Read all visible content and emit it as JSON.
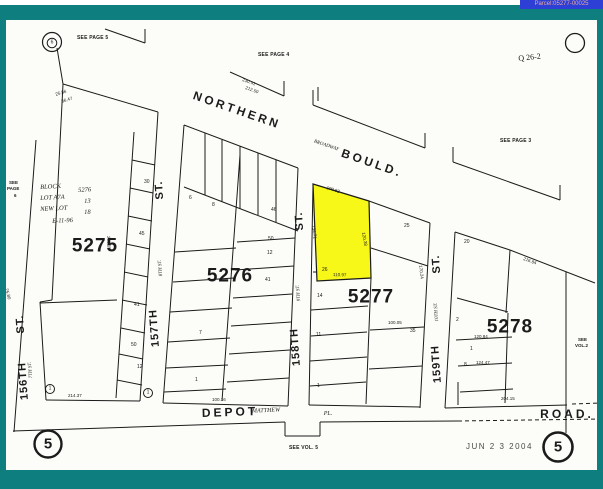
{
  "header": {
    "parcel_tag": "Parcel:05277-00025"
  },
  "colors": {
    "frame": "#0e7f7e",
    "paper": "#fcfcf8",
    "ink": "#1b1b1b",
    "highlight": "#f8f818",
    "tag_bg": "#2d3fd4",
    "tag_text": "#e9a9a1"
  },
  "map": {
    "highlight_parcel": {
      "points": "313,184 369,201 371,278 317,281"
    },
    "circles": [
      {
        "cx": 52,
        "cy": 42,
        "r": 9.5,
        "w": 1.2,
        "n": "symbol-6-outer-circle"
      },
      {
        "cx": 52,
        "cy": 43,
        "r": 4.8,
        "w": 1,
        "n": "symbol-6-inner-circle"
      },
      {
        "cx": 575,
        "cy": 43,
        "r": 9.5,
        "w": 1.3,
        "n": "corner-circle"
      },
      {
        "cx": 48,
        "cy": 444,
        "r": 13.5,
        "w": 2.4,
        "n": "page-circle-left"
      },
      {
        "cx": 558,
        "cy": 447,
        "r": 14.5,
        "w": 2.6,
        "n": "page-circle-right"
      },
      {
        "cx": 50,
        "cy": 389,
        "r": 4.5,
        "w": 1,
        "n": "lot-circle"
      },
      {
        "cx": 148,
        "cy": 393,
        "r": 4.5,
        "w": 1,
        "n": "lot-circle"
      }
    ],
    "lines": [
      [
        105,
        29,
        145,
        43
      ],
      [
        145,
        29,
        145,
        43
      ],
      [
        230,
        72,
        284,
        96
      ],
      [
        284,
        81,
        284,
        96
      ],
      [
        318,
        87,
        318,
        101
      ],
      [
        313,
        90,
        313,
        105
      ],
      [
        313,
        105,
        425,
        148
      ],
      [
        425,
        133,
        425,
        148
      ],
      [
        453,
        147,
        453,
        162
      ],
      [
        453,
        162,
        560,
        200
      ],
      [
        560,
        185,
        560,
        200
      ],
      [
        57,
        48,
        63,
        84
      ],
      [
        63,
        84,
        158,
        112
      ],
      [
        184,
        125,
        298,
        168
      ],
      [
        369,
        201,
        430,
        223
      ],
      [
        455,
        232,
        510,
        250
      ],
      [
        510,
        250,
        595,
        283
      ],
      [
        36,
        140,
        14,
        432
      ],
      [
        63,
        84,
        52,
        300
      ],
      [
        52,
        300,
        40,
        302
      ],
      [
        40,
        302,
        46,
        400
      ],
      [
        40,
        303,
        117,
        300
      ],
      [
        158,
        112,
        140,
        401
      ],
      [
        134,
        132,
        116,
        398
      ],
      [
        132,
        160,
        155,
        165
      ],
      [
        130,
        188,
        153,
        193
      ],
      [
        128,
        216,
        152,
        221
      ],
      [
        126,
        244,
        150,
        249
      ],
      [
        124,
        272,
        148,
        277
      ],
      [
        122,
        300,
        147,
        305
      ],
      [
        121,
        328,
        145,
        333
      ],
      [
        119,
        354,
        143,
        359
      ],
      [
        117,
        380,
        142,
        385
      ],
      [
        184,
        125,
        163,
        403
      ],
      [
        298,
        168,
        288,
        406
      ],
      [
        240,
        155,
        222,
        401
      ],
      [
        184,
        187,
        298,
        231
      ],
      [
        205,
        133,
        205,
        195
      ],
      [
        222,
        139,
        222,
        202
      ],
      [
        240,
        146,
        240,
        209
      ],
      [
        258,
        153,
        258,
        215
      ],
      [
        276,
        160,
        276,
        222
      ],
      [
        175,
        252,
        236,
        248
      ],
      [
        173,
        282,
        234,
        278
      ],
      [
        170,
        312,
        232,
        308
      ],
      [
        168,
        342,
        230,
        338
      ],
      [
        166,
        368,
        228,
        365
      ],
      [
        164,
        392,
        226,
        389
      ],
      [
        237,
        242,
        295,
        238
      ],
      [
        235,
        270,
        294,
        266
      ],
      [
        233,
        298,
        292,
        294
      ],
      [
        231,
        326,
        291,
        322
      ],
      [
        229,
        354,
        290,
        350
      ],
      [
        227,
        382,
        289,
        378
      ],
      [
        313,
        184,
        309,
        405
      ],
      [
        430,
        223,
        420,
        408
      ],
      [
        371,
        278,
        366,
        404
      ],
      [
        371,
        248,
        428,
        266
      ],
      [
        311,
        310,
        368,
        306
      ],
      [
        311,
        336,
        367,
        332
      ],
      [
        310,
        361,
        367,
        357
      ],
      [
        310,
        386,
        366,
        382
      ],
      [
        370,
        330,
        424,
        327
      ],
      [
        369,
        369,
        422,
        366
      ],
      [
        313,
        272,
        325,
        272
      ],
      [
        325,
        272,
        325,
        281
      ],
      [
        455,
        232,
        445,
        408
      ],
      [
        510,
        250,
        506,
        313
      ],
      [
        508,
        313,
        505,
        403
      ],
      [
        457,
        298,
        508,
        312
      ],
      [
        456,
        340,
        512,
        337
      ],
      [
        458,
        366,
        512,
        363
      ],
      [
        460,
        392,
        513,
        389
      ],
      [
        566,
        272,
        566,
        433
      ],
      [
        46,
        400,
        140,
        401
      ],
      [
        163,
        403,
        288,
        406
      ],
      [
        309,
        405,
        420,
        407
      ],
      [
        445,
        408,
        567,
        405
      ],
      [
        458,
        382,
        458,
        405
      ],
      [
        13,
        431,
        285,
        422
      ],
      [
        285,
        422,
        285,
        436
      ],
      [
        285,
        436,
        320,
        436
      ],
      [
        320,
        436,
        320,
        422
      ],
      [
        320,
        422,
        458,
        421
      ]
    ],
    "dashed": [
      [
        458,
        421,
        600,
        419
      ],
      [
        572,
        404,
        600,
        403
      ]
    ],
    "labels": [
      {
        "t": "SEE PAGE 5",
        "x": 77,
        "y": 36,
        "cls": "ref",
        "n": "see-page-5"
      },
      {
        "t": "SEE PAGE 4",
        "x": 258,
        "y": 53,
        "cls": "ref",
        "n": "see-page-4"
      },
      {
        "t": "SEE PAGE 3",
        "x": 500,
        "y": 139,
        "cls": "ref",
        "n": "see-page-3"
      },
      {
        "t": "SEE",
        "x": 9,
        "y": 181,
        "cls": "ref2",
        "n": "see-page-6"
      },
      {
        "t": "PAGE",
        "x": 7,
        "y": 187,
        "cls": "ref2",
        "n": "see-page-6"
      },
      {
        "t": "6",
        "x": 14,
        "y": 194,
        "cls": "ref2",
        "n": "see-page-6"
      },
      {
        "t": "SEE VOL. 5",
        "x": 289,
        "y": 446,
        "cls": "ref",
        "n": "see-vol-5"
      },
      {
        "t": "SEE",
        "x": 578,
        "y": 338,
        "cls": "ref2",
        "n": "see-vol-2"
      },
      {
        "t": "VOL.2",
        "x": 575,
        "y": 344,
        "cls": "ref2",
        "n": "see-vol-2"
      },
      {
        "t": "Q 26-2",
        "x": 518,
        "y": 55,
        "rot": -6,
        "cls": "qnote",
        "n": "handwritten-note"
      },
      {
        "t": "NORTHERN",
        "x": 237,
        "y": 110,
        "rot": 19,
        "ctr": 1,
        "cls": "roadname",
        "n": "street-name-northern"
      },
      {
        "t": "BOULD.",
        "x": 372,
        "y": 163,
        "rot": 19,
        "ctr": 1,
        "cls": "roadname",
        "n": "street-name-bould"
      },
      {
        "t": "BROADWAY",
        "x": 326,
        "y": 146,
        "rot": 19,
        "ctr": 1,
        "cls": "st-old",
        "n": "old-street-name-broadway"
      },
      {
        "t": "DEPOT",
        "x": 230,
        "y": 412,
        "rot": -2,
        "ctr": 1,
        "cls": "roadname",
        "n": "street-name-depot"
      },
      {
        "t": "MATTHEW",
        "x": 266,
        "y": 411,
        "rot": -2,
        "ctr": 1,
        "cls": "road-it",
        "n": "old-street-name-matthew"
      },
      {
        "t": "PL.",
        "x": 328,
        "y": 414,
        "ctr": 1,
        "cls": "road-it",
        "n": "old-street-name-pl"
      },
      {
        "t": "ROAD.",
        "x": 567,
        "y": 414,
        "ctr": 1,
        "cls": "roadname",
        "n": "street-name-road"
      },
      {
        "t": "ST.",
        "x": 21,
        "y": 324,
        "rot": -94,
        "ctr": 1,
        "cls": "st-big",
        "n": "street-156-st"
      },
      {
        "t": "156TH",
        "x": 24,
        "y": 381,
        "rot": -94,
        "ctr": 1,
        "cls": "st-big",
        "n": "street-156"
      },
      {
        "t": "7TH ST.",
        "x": 31,
        "y": 370,
        "rot": -94,
        "ctr": 1,
        "cls": "st-old",
        "n": "old-street-156"
      },
      {
        "t": "ST.",
        "x": 160,
        "y": 190,
        "rot": -94,
        "ctr": 1,
        "cls": "st-big",
        "n": "street-157-st"
      },
      {
        "t": "157TH",
        "x": 155,
        "y": 328,
        "rot": -94,
        "ctr": 1,
        "cls": "st-big",
        "n": "street-157"
      },
      {
        "t": "8TH ST.",
        "x": 161,
        "y": 268,
        "rot": -94,
        "ctr": 1,
        "cls": "st-old",
        "n": "old-street-157"
      },
      {
        "t": "ST.",
        "x": 300,
        "y": 221,
        "rot": -94,
        "ctr": 1,
        "cls": "st-big",
        "n": "street-158-st"
      },
      {
        "t": "158TH",
        "x": 296,
        "y": 347,
        "rot": -94,
        "ctr": 1,
        "cls": "st-big",
        "n": "street-158"
      },
      {
        "t": "9TH ST.",
        "x": 299,
        "y": 293,
        "rot": -94,
        "ctr": 1,
        "cls": "st-old",
        "n": "old-street-158"
      },
      {
        "t": "ST.",
        "x": 437,
        "y": 264,
        "rot": -94,
        "ctr": 1,
        "cls": "st-big",
        "n": "street-159-st"
      },
      {
        "t": "159TH",
        "x": 437,
        "y": 364,
        "rot": -94,
        "ctr": 1,
        "cls": "st-big",
        "n": "street-159"
      },
      {
        "t": "10TH ST.",
        "x": 437,
        "y": 312,
        "rot": -94,
        "ctr": 1,
        "cls": "st-old",
        "n": "old-street-159"
      },
      {
        "t": "5275",
        "x": 95,
        "y": 246,
        "ctr": 1,
        "cls": "blockno",
        "n": "block-number-5275"
      },
      {
        "t": "5276",
        "x": 230,
        "y": 276,
        "ctr": 1,
        "cls": "blockno",
        "n": "block-number-5276"
      },
      {
        "t": "5277",
        "x": 371,
        "y": 297,
        "ctr": 1,
        "cls": "blockno",
        "n": "block-number-5277"
      },
      {
        "t": "5278",
        "x": 510,
        "y": 327,
        "ctr": 1,
        "cls": "blockno",
        "n": "block-number-5278"
      },
      {
        "t": "BLOCK",
        "x": 40,
        "y": 185,
        "rot": -3,
        "cls": "hand",
        "n": "note-block"
      },
      {
        "t": "5276",
        "x": 78,
        "y": 188,
        "rot": -3,
        "cls": "hand",
        "n": "note-block-value"
      },
      {
        "t": "LOT A7A",
        "x": 40,
        "y": 196,
        "rot": -3,
        "cls": "hand",
        "n": "note-lot"
      },
      {
        "t": "13",
        "x": 84,
        "y": 199,
        "rot": -3,
        "cls": "hand",
        "n": "note-lot-value"
      },
      {
        "t": "NEW LOT",
        "x": 40,
        "y": 207,
        "rot": -3,
        "cls": "hand",
        "n": "note-newlot"
      },
      {
        "t": "18",
        "x": 84,
        "y": 210,
        "rot": -3,
        "cls": "hand",
        "n": "note-newlot-value"
      },
      {
        "t": "E-11-96",
        "x": 52,
        "y": 219,
        "rot": -3,
        "cls": "hand",
        "n": "note-date"
      },
      {
        "t": "25.86",
        "x": 55,
        "y": 93,
        "rot": -17,
        "cls": "dim"
      },
      {
        "t": "36.47",
        "x": 61,
        "y": 100,
        "rot": -17,
        "cls": "dim"
      },
      {
        "t": "230.41",
        "x": 243,
        "y": 78,
        "rot": 20,
        "cls": "dim"
      },
      {
        "t": "212.50",
        "x": 246,
        "y": 86,
        "rot": 20,
        "cls": "dim"
      },
      {
        "t": "100.62",
        "x": 327,
        "y": 186,
        "rot": 18,
        "cls": "dim"
      },
      {
        "t": "120.38",
        "x": 365,
        "y": 232,
        "rot": 80,
        "cls": "dim"
      },
      {
        "t": "134.71",
        "x": 315,
        "y": 225,
        "rot": 83,
        "cls": "dim"
      },
      {
        "t": "110.97",
        "x": 333,
        "y": 273,
        "rot": 2,
        "cls": "dim"
      },
      {
        "t": "170.24",
        "x": 422,
        "y": 265,
        "rot": 83,
        "cls": "dim"
      },
      {
        "t": "100.05",
        "x": 388,
        "y": 321,
        "cls": "dim"
      },
      {
        "t": "214.37",
        "x": 68,
        "y": 394,
        "cls": "dim"
      },
      {
        "t": "100.16",
        "x": 212,
        "y": 398,
        "cls": "dim"
      },
      {
        "t": "204.15",
        "x": 501,
        "y": 397,
        "cls": "dim"
      },
      {
        "t": "120.84",
        "x": 474,
        "y": 335,
        "cls": "dim"
      },
      {
        "t": "124.47",
        "x": 476,
        "y": 361,
        "cls": "dim"
      },
      {
        "t": "216.84",
        "x": 524,
        "y": 257,
        "rot": 20,
        "cls": "dim"
      },
      {
        "t": "25.80",
        "x": 8,
        "y": 288,
        "rot": 75,
        "cls": "dim"
      },
      {
        "t": "260.15",
        "x": 110,
        "y": 236,
        "rot": 87,
        "cls": "dim"
      },
      {
        "t": "30",
        "x": 144,
        "y": 180,
        "cls": "lot"
      },
      {
        "t": "45",
        "x": 139,
        "y": 232,
        "cls": "lot"
      },
      {
        "t": "41",
        "x": 134,
        "y": 303,
        "cls": "lot"
      },
      {
        "t": "50",
        "x": 131,
        "y": 343,
        "cls": "lot"
      },
      {
        "t": "12",
        "x": 137,
        "y": 365,
        "cls": "lot"
      },
      {
        "t": "6",
        "x": 189,
        "y": 196,
        "cls": "lot"
      },
      {
        "t": "8",
        "x": 212,
        "y": 203,
        "cls": "lot"
      },
      {
        "t": "46",
        "x": 271,
        "y": 208,
        "cls": "lot"
      },
      {
        "t": "50",
        "x": 268,
        "y": 237,
        "cls": "lot"
      },
      {
        "t": "12",
        "x": 267,
        "y": 251,
        "cls": "lot"
      },
      {
        "t": "41",
        "x": 265,
        "y": 278,
        "cls": "lot"
      },
      {
        "t": "7",
        "x": 199,
        "y": 331,
        "cls": "lot"
      },
      {
        "t": "1",
        "x": 195,
        "y": 378,
        "cls": "lot"
      },
      {
        "t": "25",
        "x": 404,
        "y": 224,
        "cls": "lot"
      },
      {
        "t": "26",
        "x": 322,
        "y": 268,
        "cls": "lot"
      },
      {
        "t": "14",
        "x": 317,
        "y": 294,
        "cls": "lot"
      },
      {
        "t": "11",
        "x": 316,
        "y": 333,
        "cls": "lot"
      },
      {
        "t": "35",
        "x": 410,
        "y": 329,
        "cls": "lot"
      },
      {
        "t": "1",
        "x": 317,
        "y": 384,
        "cls": "lot"
      },
      {
        "t": "20",
        "x": 464,
        "y": 240,
        "cls": "lot"
      },
      {
        "t": "2",
        "x": 456,
        "y": 318,
        "cls": "lot"
      },
      {
        "t": "1",
        "x": 470,
        "y": 347,
        "cls": "lot"
      },
      {
        "t": "8",
        "x": 464,
        "y": 363,
        "cls": "lot"
      },
      {
        "t": "6",
        "x": 52,
        "y": 43,
        "ctr": 1,
        "cls": "circno-sm",
        "n": "symbol-6"
      },
      {
        "t": "5",
        "x": 48,
        "y": 444,
        "ctr": 1,
        "cls": "circno-big",
        "n": "page-number-left"
      },
      {
        "t": "5",
        "x": 558,
        "y": 447,
        "ctr": 1,
        "cls": "circno-big",
        "n": "page-number-right"
      },
      {
        "t": "1",
        "x": 50,
        "y": 389,
        "ctr": 1,
        "cls": "circno-sm",
        "n": "circled-lot-1"
      },
      {
        "t": "1",
        "x": 148,
        "y": 393,
        "ctr": 1,
        "cls": "circno-sm",
        "n": "circled-lot-1"
      },
      {
        "t": "JUN 2 3 2004",
        "x": 466,
        "y": 443,
        "cls": "stamp",
        "n": "date-stamp"
      }
    ]
  }
}
